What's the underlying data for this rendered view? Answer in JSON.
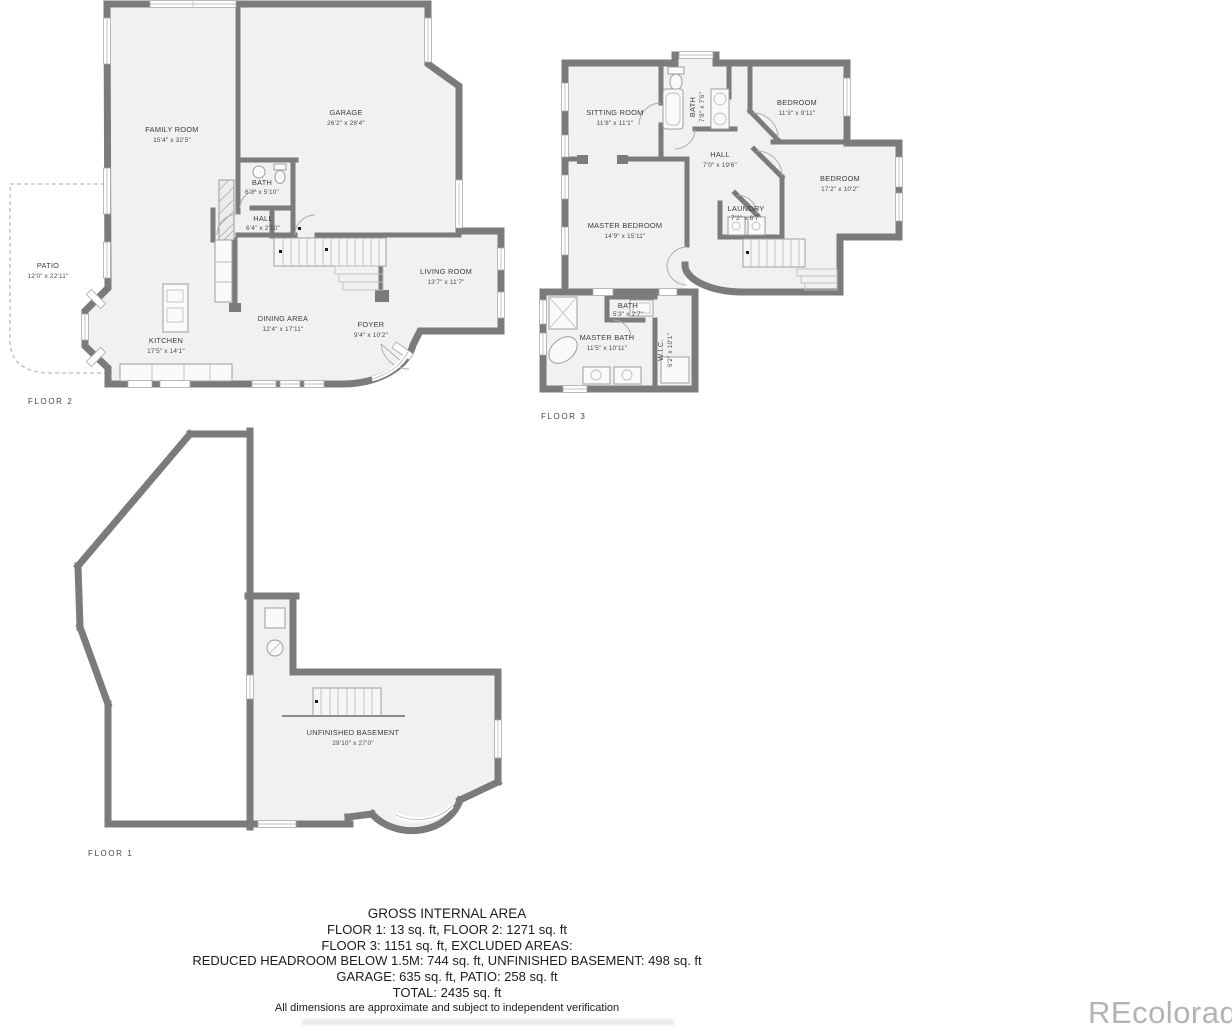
{
  "colors": {
    "wall": "#7b7b7b",
    "room_fill": "#f1f1f1",
    "watermark": "#b3b3b3"
  },
  "floors": {
    "floor2": {
      "label": "FLOOR 2",
      "rooms": {
        "family_room": {
          "name": "FAMILY ROOM",
          "dims": "15'4\" x 32'5\""
        },
        "garage": {
          "name": "GARAGE",
          "dims": "26'2\" x 28'4\""
        },
        "bath": {
          "name": "BATH",
          "dims": "6'3\" x 5'10\""
        },
        "hall": {
          "name": "HALL",
          "dims": "6'4\" x 2'10\""
        },
        "living_room": {
          "name": "LIVING ROOM",
          "dims": "13'7\" x 11'7\""
        },
        "dining_area": {
          "name": "DINING AREA",
          "dims": "12'4\" x 17'11\""
        },
        "foyer": {
          "name": "FOYER",
          "dims": "9'4\" x 10'2\""
        },
        "kitchen": {
          "name": "KITCHEN",
          "dims": "17'5\" x 14'1\""
        },
        "patio": {
          "name": "PATIO",
          "dims": "12'0\" x 22'11\""
        }
      }
    },
    "floor3": {
      "label": "FLOOR 3",
      "rooms": {
        "sitting_room": {
          "name": "SITTING ROOM",
          "dims": "11'8\" x 11'1\""
        },
        "bath_top": {
          "name": "BATH",
          "dims": "7'8\" x 7'6\""
        },
        "bedroom_small": {
          "name": "BEDROOM",
          "dims": "11'3\" x 9'11\""
        },
        "hall": {
          "name": "HALL",
          "dims": "7'0\" x 19'6\""
        },
        "bedroom_large": {
          "name": "BEDROOM",
          "dims": "17'2\" x 10'2\""
        },
        "laundry": {
          "name": "LAUNDRY",
          "dims": "7'2\" x 6'7\""
        },
        "master_bedroom": {
          "name": "MASTER BEDROOM",
          "dims": "14'9\" x 15'11\""
        },
        "bath_small": {
          "name": "BATH",
          "dims": "5'3\" x 2'7\""
        },
        "master_bath": {
          "name": "MASTER BATH",
          "dims": "11'5\" x 10'11\""
        },
        "wic": {
          "name": "W.I.C.",
          "dims": "6'2\" x 10'1\""
        }
      }
    },
    "floor1": {
      "label": "FLOOR 1",
      "rooms": {
        "basement": {
          "name": "UNFINISHED BASEMENT",
          "dims": "29'10\" x 27'0\""
        }
      }
    }
  },
  "summary": {
    "title": "GROSS INTERNAL AREA",
    "lines": [
      "FLOOR 1: 13 sq. ft, FLOOR 2: 1271 sq. ft",
      "FLOOR 3: 1151 sq. ft, EXCLUDED AREAS:",
      "REDUCED HEADROOM BELOW 1.5M: 744 sq. ft, UNFINISHED BASEMENT: 498 sq. ft",
      "GARAGE: 635 sq. ft, PATIO: 258 sq. ft",
      "TOTAL: 2435 sq. ft"
    ],
    "disclaimer": "All dimensions are approximate and subject to independent verification"
  },
  "watermark": "REcolorado"
}
